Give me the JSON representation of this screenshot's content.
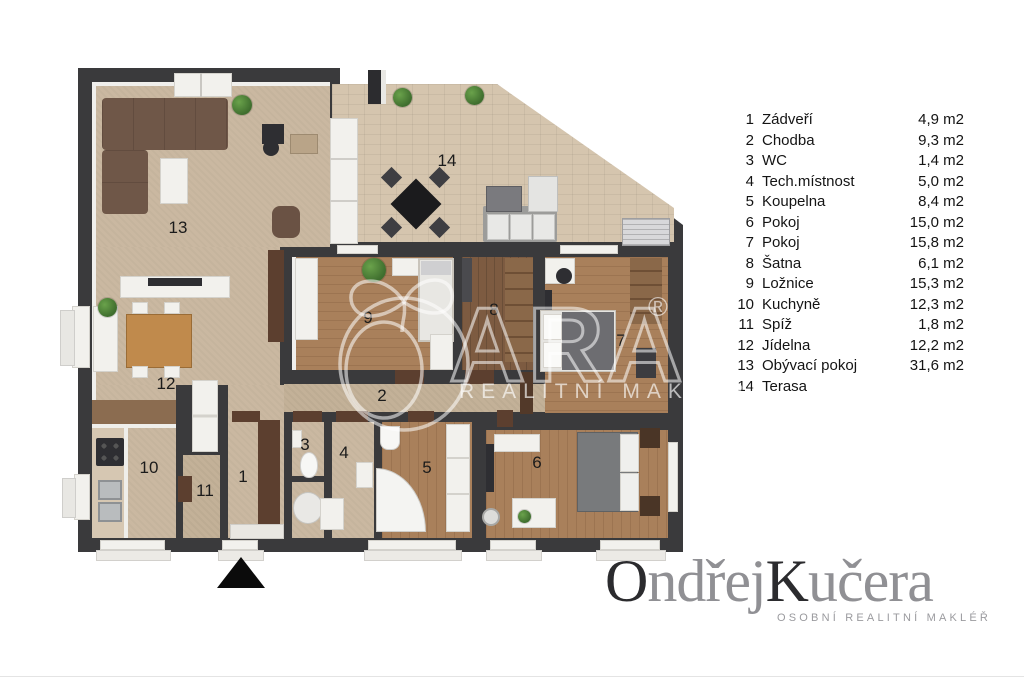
{
  "legend": {
    "rows": [
      {
        "num": "1",
        "name": "Zádveří",
        "area": "4,9 m2"
      },
      {
        "num": "2",
        "name": "Chodba",
        "area": "9,3 m2"
      },
      {
        "num": "3",
        "name": "WC",
        "area": "1,4 m2"
      },
      {
        "num": "4",
        "name": "Tech.místnost",
        "area": "5,0 m2"
      },
      {
        "num": "5",
        "name": "Koupelna",
        "area": "8,4 m2"
      },
      {
        "num": "6",
        "name": "Pokoj",
        "area": "15,0 m2"
      },
      {
        "num": "7",
        "name": "Pokoj",
        "area": "15,8 m2"
      },
      {
        "num": "8",
        "name": "Šatna",
        "area": "6,1 m2"
      },
      {
        "num": "9",
        "name": "Ložnice",
        "area": "15,3 m2"
      },
      {
        "num": "10",
        "name": "Kuchyně",
        "area": "12,3 m2"
      },
      {
        "num": "11",
        "name": "Spíž",
        "area": "1,8 m2"
      },
      {
        "num": "12",
        "name": "Jídelna",
        "area": "12,2 m2"
      },
      {
        "num": "13",
        "name": "Obývací pokoj",
        "area": "31,6 m2"
      },
      {
        "num": "14",
        "name": "Terasa",
        "area": ""
      }
    ]
  },
  "plan": {
    "labels": [
      {
        "num": "1",
        "x": 243,
        "y": 477
      },
      {
        "num": "2",
        "x": 382,
        "y": 396
      },
      {
        "num": "3",
        "x": 305,
        "y": 445
      },
      {
        "num": "4",
        "x": 344,
        "y": 453
      },
      {
        "num": "5",
        "x": 427,
        "y": 468
      },
      {
        "num": "6",
        "x": 537,
        "y": 463
      },
      {
        "num": "7",
        "x": 621,
        "y": 341
      },
      {
        "num": "8",
        "x": 494,
        "y": 310
      },
      {
        "num": "9",
        "x": 368,
        "y": 318
      },
      {
        "num": "10",
        "x": 149,
        "y": 468
      },
      {
        "num": "11",
        "x": 205,
        "y": 491
      },
      {
        "num": "12",
        "x": 166,
        "y": 384
      },
      {
        "num": "13",
        "x": 178,
        "y": 228
      },
      {
        "num": "14",
        "x": 447,
        "y": 161
      }
    ]
  },
  "watermark": {
    "brand": "ARA",
    "registered": "®",
    "tagline": "REALITNÍ MAKLÉŘI"
  },
  "logo": {
    "part1": "O",
    "part2": "ndřej",
    "part3": "K",
    "part4": "učera",
    "tagline": "OSOBNÍ REALITNÍ MAKLÉŘ"
  },
  "colors": {
    "wall": "#3a3a3c",
    "carpet": "#cab8a1",
    "tile": "#d5c5ae",
    "wood": "#a9805b",
    "wood_dark": "#7d5b41",
    "accent_brown": "#5c3f2f"
  }
}
